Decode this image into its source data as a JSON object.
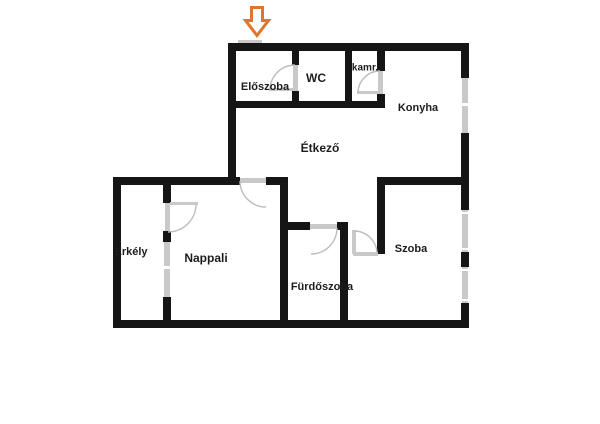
{
  "floorplan": {
    "background_color": "#ffffff",
    "wall_color": "#151515",
    "opening_color": "#c9c9c9",
    "label_color": "#1c1c1c",
    "entrance_arrow_color": "#e0752c",
    "entrance_arrow": "down-arrow",
    "rooms": {
      "eloszoba": {
        "label": "Előszoba"
      },
      "wc": {
        "label": "WC"
      },
      "kamra": {
        "label": "kamr."
      },
      "konyha": {
        "label": "Konyha"
      },
      "etkezo": {
        "label": "Étkező"
      },
      "erkely": {
        "label": "Erkély"
      },
      "nappali": {
        "label": "Nappali"
      },
      "furdoszoba": {
        "label": "Fürdőszoba"
      },
      "szoba": {
        "label": "Szoba"
      }
    }
  }
}
